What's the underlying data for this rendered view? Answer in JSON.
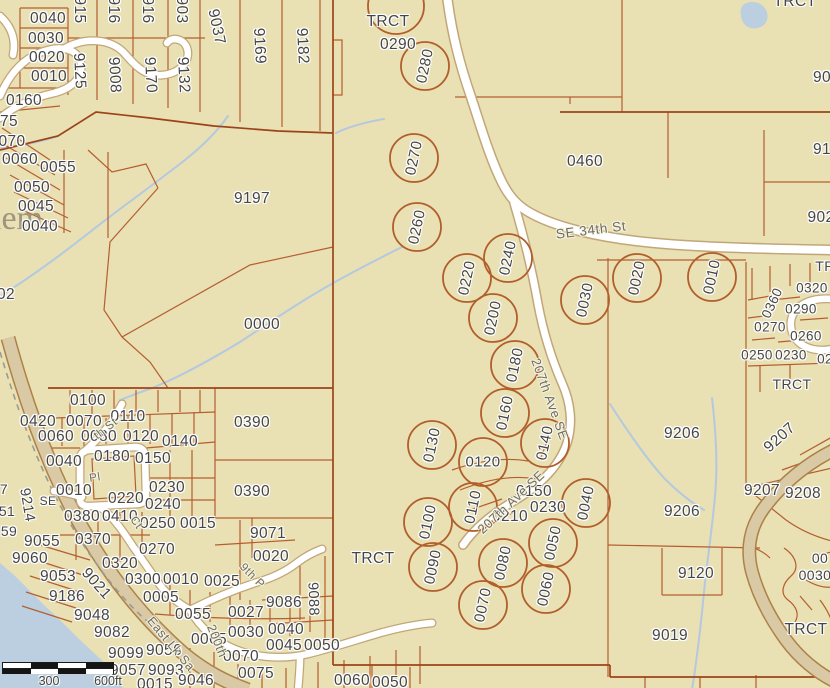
{
  "map": {
    "colors": {
      "background": "#e9e0b3",
      "parcel_line": "#b2582a",
      "major_line": "#9c4418",
      "circle": "#b15e2b",
      "road_fill": "#ffffff",
      "road_casing": "#c2a678",
      "parkway_fill": "#d9c9a4",
      "parkway_edge": "#ad8148",
      "water": "#bccfe0",
      "stream": "#b4c9e0",
      "label_text": "#464646",
      "street_text": "#6d6d5f"
    },
    "watermark": "lem",
    "scale_bar": {
      "label_300": "300",
      "label_600": "600ft"
    },
    "parcel_labels": [
      {
        "t": "0040",
        "x": 48,
        "y": 19
      },
      {
        "t": "0030",
        "x": 46,
        "y": 39
      },
      {
        "t": "0020",
        "x": 47,
        "y": 58
      },
      {
        "t": "0010",
        "x": 49,
        "y": 77
      },
      {
        "t": "0160",
        "x": 24,
        "y": 101
      },
      {
        "t": "75",
        "x": 9,
        "y": 122
      },
      {
        "t": "070",
        "x": 12,
        "y": 142
      },
      {
        "t": "0060",
        "x": 20,
        "y": 160
      },
      {
        "t": "0055",
        "x": 58,
        "y": 168
      },
      {
        "t": "0050",
        "x": 32,
        "y": 188
      },
      {
        "t": "0045",
        "x": 36,
        "y": 207
      },
      {
        "t": "0040",
        "x": 40,
        "y": 227
      },
      {
        "t": "915",
        "x": 79,
        "y": 10,
        "r": 90
      },
      {
        "t": "916",
        "x": 113,
        "y": 10,
        "r": 90
      },
      {
        "t": "916",
        "x": 147,
        "y": 10,
        "r": 90
      },
      {
        "t": "903",
        "x": 181,
        "y": 10,
        "r": 90
      },
      {
        "t": "9037",
        "x": 216,
        "y": 27,
        "r": 78
      },
      {
        "t": "9169",
        "x": 259,
        "y": 46,
        "r": 87
      },
      {
        "t": "9182",
        "x": 302,
        "y": 46,
        "r": 87
      },
      {
        "t": "9125",
        "x": 79,
        "y": 71,
        "r": 87
      },
      {
        "t": "9008",
        "x": 114,
        "y": 75,
        "r": 87
      },
      {
        "t": "9170",
        "x": 150,
        "y": 75,
        "r": 87
      },
      {
        "t": "9132",
        "x": 183,
        "y": 75,
        "r": 87
      },
      {
        "t": "02",
        "x": 6,
        "y": 295
      },
      {
        "t": "9197",
        "x": 252,
        "y": 199
      },
      {
        "t": "0000",
        "x": 262,
        "y": 325
      },
      {
        "t": "TRCT",
        "x": 388,
        "y": 22
      },
      {
        "t": "0290",
        "x": 398,
        "y": 45
      },
      {
        "t": "0460",
        "x": 585,
        "y": 162
      },
      {
        "t": "TRCT",
        "x": 795,
        "y": 2
      },
      {
        "t": "90",
        "x": 822,
        "y": 78
      },
      {
        "t": "91",
        "x": 822,
        "y": 150
      },
      {
        "t": "902",
        "x": 821,
        "y": 218
      },
      {
        "t": "TR",
        "x": 825,
        "y": 266,
        "s": 14
      },
      {
        "t": "0360",
        "x": 772,
        "y": 303,
        "r": -65,
        "s": 13.5
      },
      {
        "t": "0320",
        "x": 812,
        "y": 288,
        "s": 13.5
      },
      {
        "t": "0290",
        "x": 801,
        "y": 309,
        "s": 13.5
      },
      {
        "t": "0270",
        "x": 770,
        "y": 327,
        "s": 13.5
      },
      {
        "t": "0260",
        "x": 806,
        "y": 336,
        "s": 13.5
      },
      {
        "t": "0250",
        "x": 757,
        "y": 355,
        "s": 13.5
      },
      {
        "t": "0230",
        "x": 791,
        "y": 355,
        "s": 13.5
      },
      {
        "t": "02",
        "x": 825,
        "y": 359,
        "s": 13.5
      },
      {
        "t": "TRCT",
        "x": 792,
        "y": 384,
        "s": 14
      },
      {
        "t": "0100",
        "x": 88,
        "y": 401
      },
      {
        "t": "0390",
        "x": 252,
        "y": 423
      },
      {
        "t": "0420",
        "x": 38,
        "y": 422
      },
      {
        "t": "0070",
        "x": 84,
        "y": 422
      },
      {
        "t": "0110",
        "x": 128,
        "y": 417
      },
      {
        "t": "0060",
        "x": 56,
        "y": 437
      },
      {
        "t": "0080",
        "x": 99,
        "y": 437
      },
      {
        "t": "0120",
        "x": 141,
        "y": 437
      },
      {
        "t": "0140",
        "x": 180,
        "y": 442
      },
      {
        "t": "0040",
        "x": 64,
        "y": 462
      },
      {
        "t": "0180",
        "x": 112,
        "y": 457
      },
      {
        "t": "0150",
        "x": 153,
        "y": 459
      },
      {
        "t": "9214",
        "x": 27,
        "y": 505,
        "r": 80,
        "s": 14.5
      },
      {
        "t": "SE",
        "x": 48,
        "y": 501,
        "s": 12
      },
      {
        "t": "0010",
        "x": 74,
        "y": 491
      },
      {
        "t": "0230",
        "x": 167,
        "y": 488
      },
      {
        "t": "0220",
        "x": 126,
        "y": 499
      },
      {
        "t": "0240",
        "x": 163,
        "y": 505
      },
      {
        "t": "0390",
        "x": 252,
        "y": 492
      },
      {
        "t": "0380",
        "x": 82,
        "y": 517
      },
      {
        "t": "0410",
        "x": 120,
        "y": 517
      },
      {
        "t": "0250",
        "x": 158,
        "y": 524
      },
      {
        "t": "0015",
        "x": 198,
        "y": 524
      },
      {
        "t": "0370",
        "x": 93,
        "y": 540
      },
      {
        "t": "9071",
        "x": 268,
        "y": 534
      },
      {
        "t": "0270",
        "x": 157,
        "y": 550
      },
      {
        "t": "0020",
        "x": 271,
        "y": 557
      },
      {
        "t": "0320",
        "x": 120,
        "y": 564
      },
      {
        "t": "9055",
        "x": 42,
        "y": 542
      },
      {
        "t": "9060",
        "x": 30,
        "y": 559
      },
      {
        "t": "7",
        "x": 4,
        "y": 489,
        "s": 14
      },
      {
        "t": "51",
        "x": 7,
        "y": 511,
        "s": 14
      },
      {
        "t": "59",
        "x": 9,
        "y": 531,
        "s": 14
      },
      {
        "t": "9053",
        "x": 58,
        "y": 577
      },
      {
        "t": "9021",
        "x": 96,
        "y": 584,
        "r": 48
      },
      {
        "t": "9186",
        "x": 67,
        "y": 597
      },
      {
        "t": "0300",
        "x": 143,
        "y": 580
      },
      {
        "t": "0010",
        "x": 181,
        "y": 580
      },
      {
        "t": "0025",
        "x": 222,
        "y": 582
      },
      {
        "t": "9048",
        "x": 92,
        "y": 616
      },
      {
        "t": "0005",
        "x": 161,
        "y": 598
      },
      {
        "t": "0055",
        "x": 193,
        "y": 615
      },
      {
        "t": "0027",
        "x": 246,
        "y": 613
      },
      {
        "t": "9086",
        "x": 284,
        "y": 603
      },
      {
        "t": "9088",
        "x": 313,
        "y": 599,
        "r": 88,
        "s": 14.5
      },
      {
        "t": "9082",
        "x": 112,
        "y": 633
      },
      {
        "t": "0065",
        "x": 209,
        "y": 640
      },
      {
        "t": "0030",
        "x": 246,
        "y": 633
      },
      {
        "t": "0040",
        "x": 286,
        "y": 630
      },
      {
        "t": "9099",
        "x": 126,
        "y": 654
      },
      {
        "t": "9056",
        "x": 164,
        "y": 651
      },
      {
        "t": "0045",
        "x": 284,
        "y": 646
      },
      {
        "t": "0050",
        "x": 322,
        "y": 646
      },
      {
        "t": "0070",
        "x": 241,
        "y": 657
      },
      {
        "t": "9057",
        "x": 128,
        "y": 671
      },
      {
        "t": "9093",
        "x": 166,
        "y": 671
      },
      {
        "t": "0075",
        "x": 256,
        "y": 674
      },
      {
        "t": "0015",
        "x": 155,
        "y": 685
      },
      {
        "t": "9046",
        "x": 196,
        "y": 681
      },
      {
        "t": "0060",
        "x": 352,
        "y": 681
      },
      {
        "t": "0050",
        "x": 390,
        "y": 683
      },
      {
        "t": "TRCT",
        "x": 373,
        "y": 559
      },
      {
        "t": "0150",
        "x": 534,
        "y": 492
      },
      {
        "t": "0230",
        "x": 548,
        "y": 508
      },
      {
        "t": "0210",
        "x": 510,
        "y": 517
      },
      {
        "t": "9206",
        "x": 682,
        "y": 434
      },
      {
        "t": "9206",
        "x": 682,
        "y": 512
      },
      {
        "t": "9207",
        "x": 780,
        "y": 438,
        "r": -42
      },
      {
        "t": "9207",
        "x": 762,
        "y": 491
      },
      {
        "t": "9208",
        "x": 803,
        "y": 494
      },
      {
        "t": "9120",
        "x": 696,
        "y": 574
      },
      {
        "t": "9019",
        "x": 670,
        "y": 636
      },
      {
        "t": "00",
        "x": 820,
        "y": 558,
        "s": 14
      },
      {
        "t": "0030",
        "x": 815,
        "y": 575,
        "s": 14
      },
      {
        "t": "TRCT",
        "x": 806,
        "y": 630
      }
    ],
    "circled_lots": [
      {
        "t": "",
        "x": 396,
        "y": 6,
        "rr": 28
      },
      {
        "t": "0280",
        "x": 425,
        "y": 66
      },
      {
        "t": "0270",
        "x": 414,
        "y": 158
      },
      {
        "t": "0260",
        "x": 417,
        "y": 227
      },
      {
        "t": "0240",
        "x": 508,
        "y": 258
      },
      {
        "t": "0220",
        "x": 467,
        "y": 278
      },
      {
        "t": "0200",
        "x": 493,
        "y": 318
      },
      {
        "t": "0180",
        "x": 515,
        "y": 365
      },
      {
        "t": "0030",
        "x": 585,
        "y": 300
      },
      {
        "t": "0020",
        "x": 637,
        "y": 278
      },
      {
        "t": "0010",
        "x": 712,
        "y": 277
      },
      {
        "t": "0160",
        "x": 505,
        "y": 413
      },
      {
        "t": "0140",
        "x": 545,
        "y": 443
      },
      {
        "t": "0130",
        "x": 432,
        "y": 445
      },
      {
        "t": "0120",
        "x": 483,
        "y": 462,
        "tr": 0
      },
      {
        "t": "0110",
        "x": 473,
        "y": 507
      },
      {
        "t": "0100",
        "x": 428,
        "y": 522
      },
      {
        "t": "0040",
        "x": 586,
        "y": 503
      },
      {
        "t": "0050",
        "x": 553,
        "y": 543
      },
      {
        "t": "0090",
        "x": 433,
        "y": 567
      },
      {
        "t": "0080",
        "x": 503,
        "y": 563
      },
      {
        "t": "0070",
        "x": 483,
        "y": 605
      },
      {
        "t": "0060",
        "x": 546,
        "y": 589
      }
    ],
    "street_labels": [
      {
        "t": "SE 34th St",
        "x": 591,
        "y": 230,
        "r": -7,
        "s": 13.5
      },
      {
        "t": "207th Ave SE",
        "x": 550,
        "y": 399,
        "r": 70,
        "s": 13
      },
      {
        "t": "207th Ave SE",
        "x": 511,
        "y": 502,
        "r": -43,
        "s": 13
      },
      {
        "t": "East Lk Sa",
        "x": 171,
        "y": 644,
        "r": 50,
        "s": 12.5
      },
      {
        "t": "200th",
        "x": 217,
        "y": 641,
        "r": 68,
        "s": 12.5
      },
      {
        "t": "th St",
        "x": 106,
        "y": 429,
        "r": -38,
        "s": 11.5
      },
      {
        "t": "Pl",
        "x": 95,
        "y": 478,
        "r": -8,
        "s": 11.5
      },
      {
        "t": "Ct",
        "x": 136,
        "y": 523,
        "r": 55,
        "s": 11.5
      },
      {
        "t": "9th P",
        "x": 252,
        "y": 576,
        "r": 45,
        "s": 11.5
      }
    ]
  }
}
